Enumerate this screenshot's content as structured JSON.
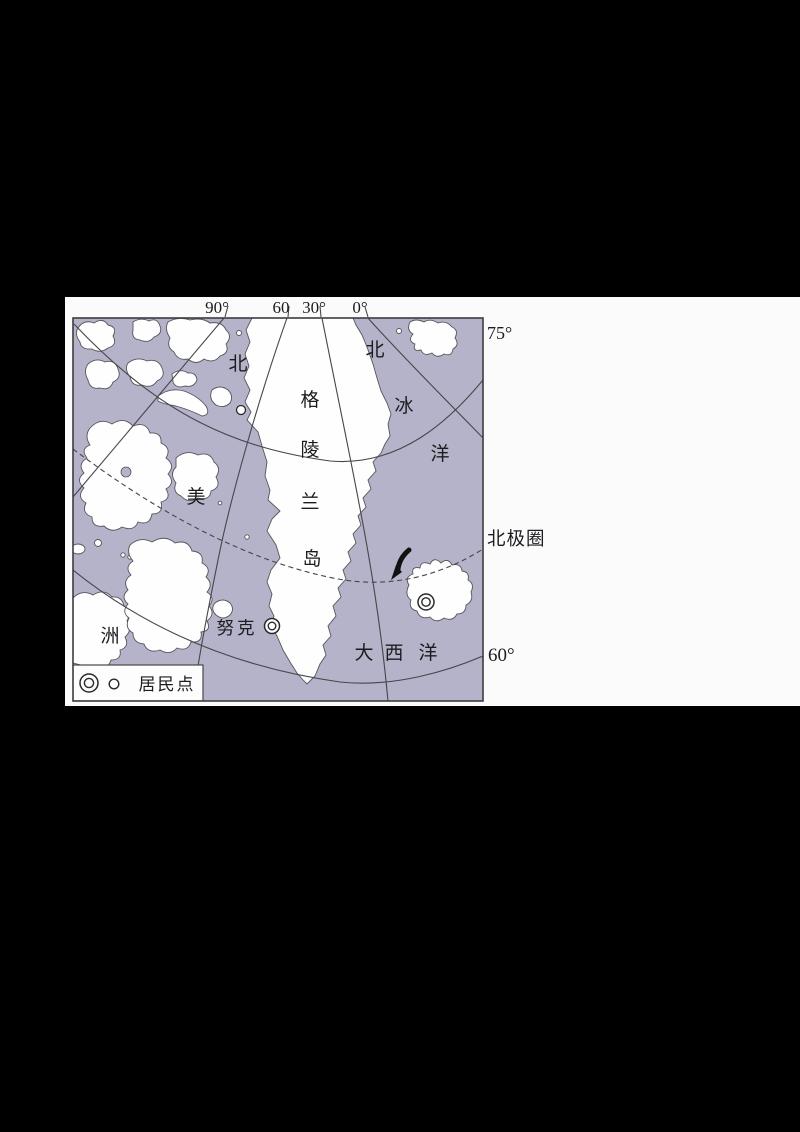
{
  "colors": {
    "page_bg": "#000000",
    "panel_bg": "#fbfbfb",
    "ocean": "#b4b3c9",
    "land": "#fefefe",
    "line": "#46464b",
    "text": "#1c1c20"
  },
  "top_axis": {
    "longitude_labels": [
      "90°",
      "60",
      "30°",
      "0°"
    ]
  },
  "right_axis": {
    "lat_75": "75°",
    "lat_60": "60°",
    "arctic_circle": "北极圈"
  },
  "map_labels": {
    "arctic_ocean_chars": [
      "北",
      "冰",
      "洋"
    ],
    "atlantic_ocean_chars": [
      "大",
      "西",
      "洋"
    ],
    "greenland_chars": [
      "格",
      "陵",
      "兰",
      "岛"
    ],
    "north_america_chars": [
      "北",
      "美",
      "洲"
    ],
    "nuuk": "努克"
  },
  "legend": {
    "label": "居民点",
    "symbols": [
      "double-circle",
      "small-circle"
    ]
  },
  "markers": {
    "nuuk": "double-circle",
    "iceland_city": "double-circle",
    "nw_greenland": "small-circle"
  }
}
